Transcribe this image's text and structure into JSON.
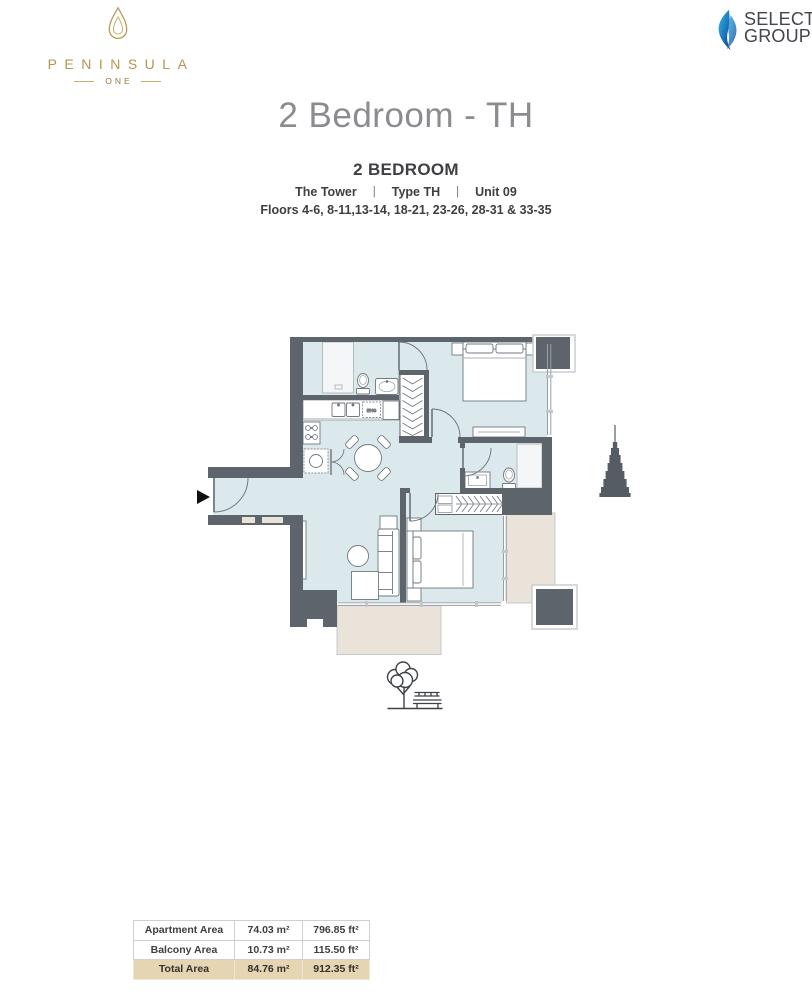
{
  "brand": {
    "peninsula": {
      "name": "PENINSULA",
      "sub": "ONE"
    },
    "select": {
      "line1": "SELECT",
      "line2": "GROUP"
    }
  },
  "page": {
    "title": "2 Bedroom - TH"
  },
  "unit": {
    "heading": "2 BEDROOM",
    "tower": "The Tower",
    "type": "Type TH",
    "unit_no": "Unit 09",
    "divider": "|",
    "floors": "Floors 4-6, 8-11,13-14, 18-21, 23-26, 28-31 & 33-35"
  },
  "floor_plan": {
    "kitchen_label": "EHG"
  },
  "area_table": {
    "rows": [
      {
        "label": "Apartment Area",
        "sqm": "74.03 m²",
        "sqft": "796.85 ft²"
      },
      {
        "label": "Balcony Area",
        "sqm": "10.73 m²",
        "sqft": "115.50 ft²"
      },
      {
        "label": "Total Area",
        "sqm": "84.76 m²",
        "sqft": "912.35 ft²"
      }
    ]
  },
  "colors": {
    "accent_gold": "#b5954f",
    "select_blue": "#1b75bb",
    "wall": "#5d646b",
    "floor": "#dbe8ec",
    "balcony": "#eae3d9",
    "table_highlight": "#e5d5b3"
  }
}
